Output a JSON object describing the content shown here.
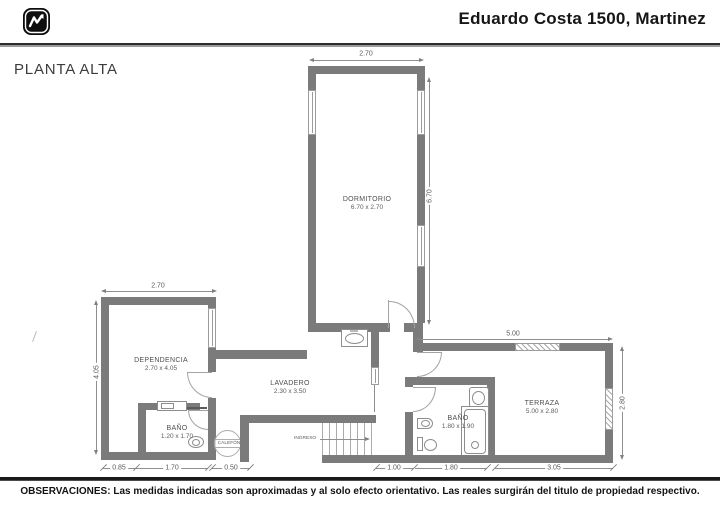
{
  "header": {
    "title": "Eduardo Costa 1500, Martinez"
  },
  "plan": {
    "floor_label": "PLANTA ALTA",
    "wall_color": "#7b7b7b",
    "rooms": [
      {
        "name": "DORMITORIO",
        "size": "6.70 x 2.70"
      },
      {
        "name": "DEPENDENCIA",
        "size": "2.70 x 4.05"
      },
      {
        "name": "LAVADERO",
        "size": "2.30 x 3.50"
      },
      {
        "name": "BAÑO",
        "size": "1.20 x 1.70"
      },
      {
        "name": "BAÑO",
        "size": "1.80 x 1.90"
      },
      {
        "name": "TERRAZA",
        "size": "5.00 x 2.80"
      }
    ],
    "annotations": {
      "ingreso": "INGRESO",
      "calefon": "CALEFÓN"
    },
    "dimensions": {
      "dorm_w": "2.70",
      "dorm_h": "6.70",
      "dep_w": "2.70",
      "dep_h": "4.05",
      "terrace_w": "5.00",
      "terrace_h": "2.80",
      "bottom": [
        "0.85",
        "1.70",
        "0.50",
        "1.00",
        "1.80",
        "3.05"
      ]
    }
  },
  "footer": {
    "text": "OBSERVACIONES: Las medidas indicadas son aproximadas y al solo efecto orientativo. Las reales surgirán del titulo de propiedad respectivo."
  }
}
